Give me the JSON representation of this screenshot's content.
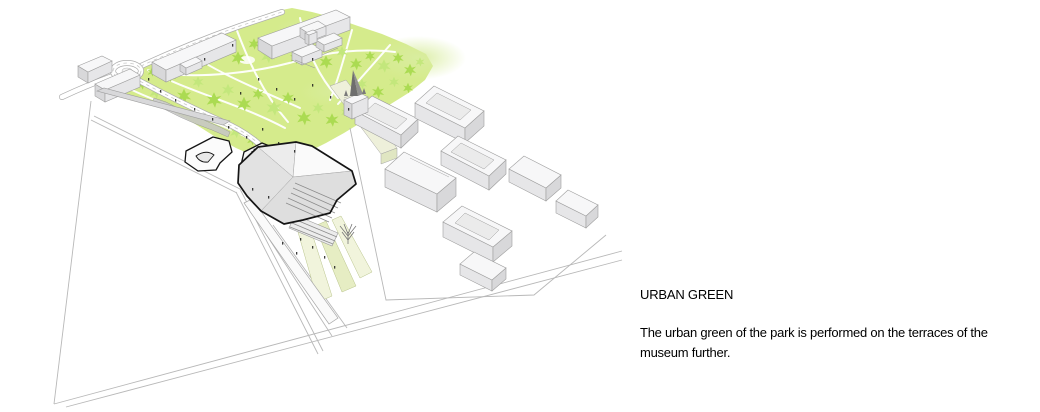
{
  "page": {
    "width": 1040,
    "height": 412,
    "background": "#ffffff"
  },
  "caption": {
    "title": "URBAN GREEN",
    "body": "The urban green of the park is performed on the terraces of the museum further.",
    "body_lines": [
      "The urban green of the park is performed on the terraces of the",
      "museum further."
    ]
  },
  "illustration": {
    "type": "axonometric-site-diagram",
    "description": "Aerial axonometric diagram of a museum site: green park with trees at the top, black-outlined museum volume with terraces at the center, white city blocks with courtyards to the right, roads, a roundabout and thin site-boundary lines below.",
    "colors": {
      "page_bg": "#ffffff",
      "park_green": "#d5eb8c",
      "tree_green": "#abdb52",
      "tree_green_light": "#c3e77c",
      "glow_green": "#dcefa5",
      "path_white": "#ffffff",
      "building_top": "#f7f7f8",
      "building_front": "#e6e6e8",
      "building_side": "#d8d8da",
      "building_edge": "#9e9e9e",
      "courtyard_grey": "#ebebeb",
      "strip_face": "#eef0da",
      "strip_side": "#e0e6c2",
      "museum_fill": "#f4f4f4",
      "museum_outline": "#151515",
      "ramp_light": "#f1f4dc",
      "ramp_mid": "#e6edc3",
      "ground_line": "#b8b8b8",
      "spire_dark": "#6e6e6e",
      "spire_light": "#909090",
      "people": "#1c1c1c",
      "text_black": "#000000"
    }
  }
}
